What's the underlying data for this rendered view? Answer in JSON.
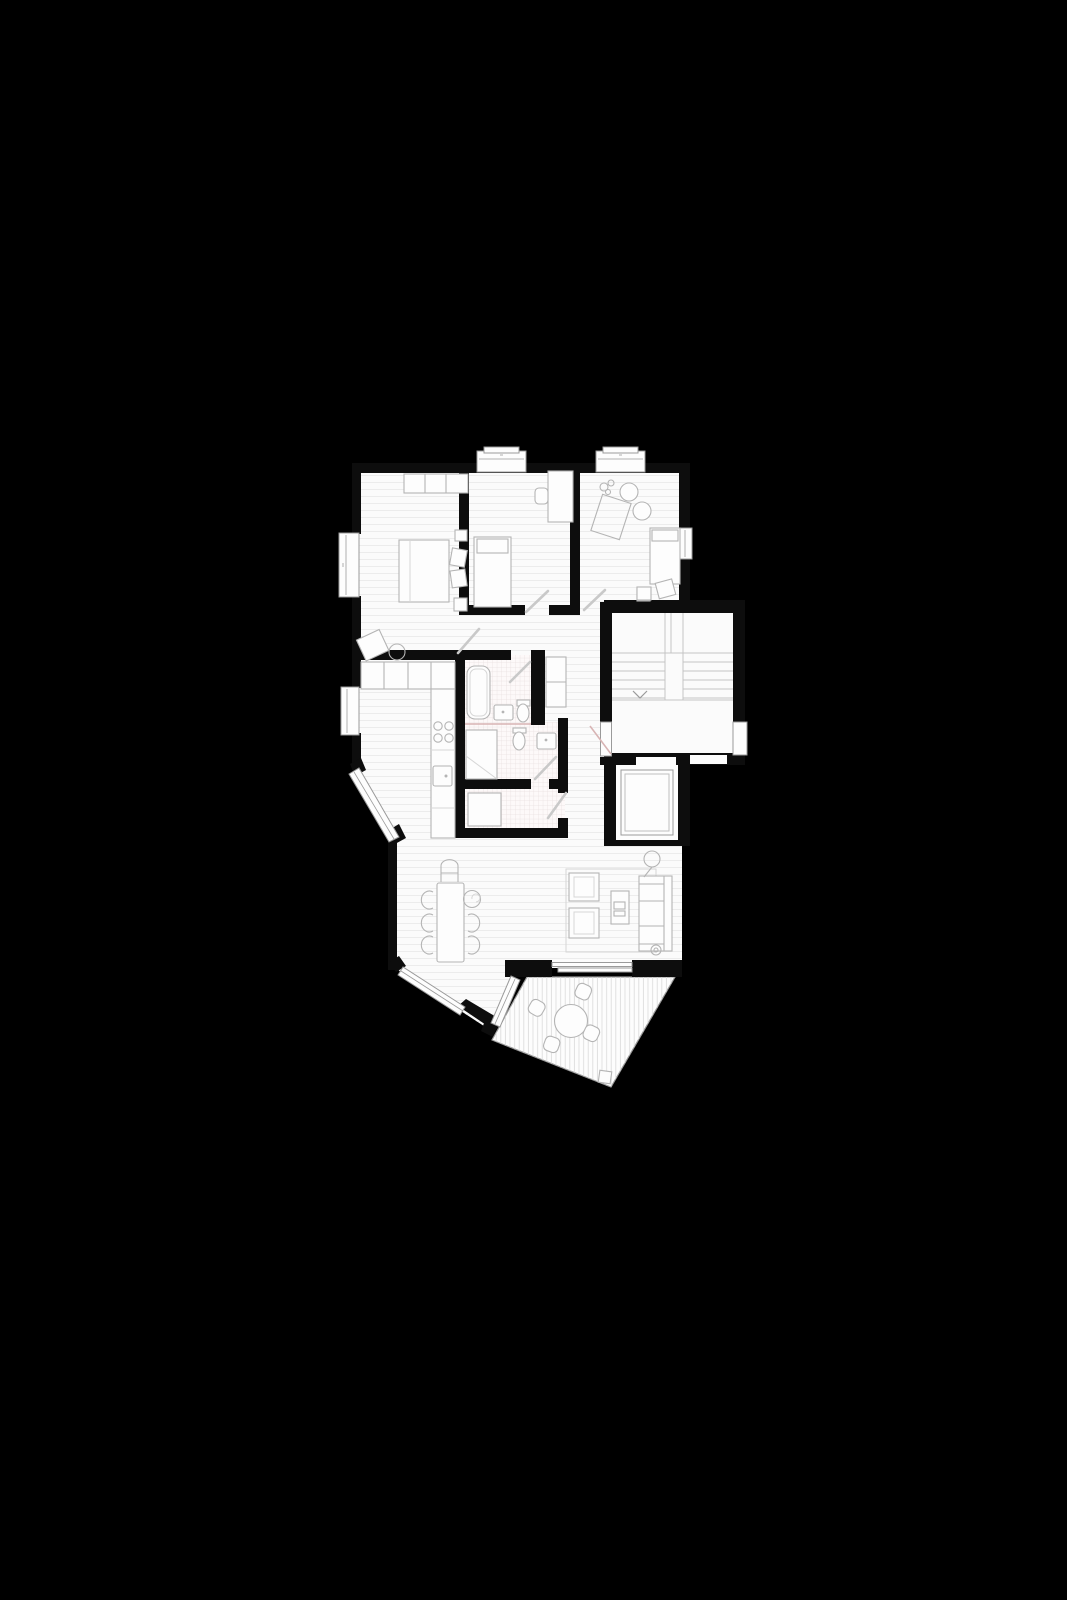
{
  "page": {
    "background": "#000000"
  },
  "palette": {
    "bg": "#000000",
    "wall": "#0d0d0d",
    "floor": "#fbfbfb",
    "floor_line": "#ececec",
    "tile_line": "#e8dfdf",
    "deck_line": "#d9d9d9",
    "furniture": "#b4b4b4",
    "furniture_light": "#d6d6d6",
    "window": "#9a9a9a",
    "door": "#c9c9c9",
    "accent_pink": "#d8b4b4",
    "stair_line": "#c4c4c4",
    "white": "#fdfdfd"
  },
  "plan": {
    "type": "apartment-floor-plan",
    "rooms": [
      {
        "id": "bedroom-1",
        "features": [
          "wardrobe",
          "double-bed",
          "two-pillows",
          "nightstands",
          "armchair",
          "pouf",
          "side-window"
        ]
      },
      {
        "id": "bedroom-2",
        "features": [
          "single-bed",
          "desk",
          "desk-chair",
          "top-bay-window"
        ]
      },
      {
        "id": "bedroom-3",
        "features": [
          "rug",
          "two-round-poufs",
          "plant",
          "single-bed",
          "side-table",
          "rotated-chair",
          "top-bay-window",
          "side-window"
        ]
      },
      {
        "id": "hallway",
        "features": [
          "wardrobe",
          "entrance-door"
        ]
      },
      {
        "id": "kitchen",
        "features": [
          "upper-cabinets",
          "counter",
          "cooktop-4-burners",
          "sink",
          "side-window",
          "angled-window"
        ]
      },
      {
        "id": "bathroom-1",
        "features": [
          "bathtub",
          "washbasin",
          "toilet"
        ]
      },
      {
        "id": "bathroom-2",
        "features": [
          "shower",
          "toilet",
          "washbasin"
        ]
      },
      {
        "id": "storage-room",
        "features": [
          "cabinet"
        ]
      },
      {
        "id": "living-dining-room",
        "features": [
          "dining-table",
          "six-chairs",
          "high-chair",
          "rug",
          "two-armchairs",
          "coffee-table",
          "sofa",
          "floor-lamp",
          "sliding-glass-door",
          "angled-window"
        ]
      },
      {
        "id": "stairwell",
        "features": [
          "two-flights",
          "landing",
          "down-arrow",
          "neighbour-door"
        ]
      },
      {
        "id": "elevator",
        "features": [
          "elevator-car"
        ]
      },
      {
        "id": "terrace",
        "features": [
          "deck-boards",
          "round-table",
          "four-chairs",
          "corner-fixture"
        ]
      }
    ]
  }
}
